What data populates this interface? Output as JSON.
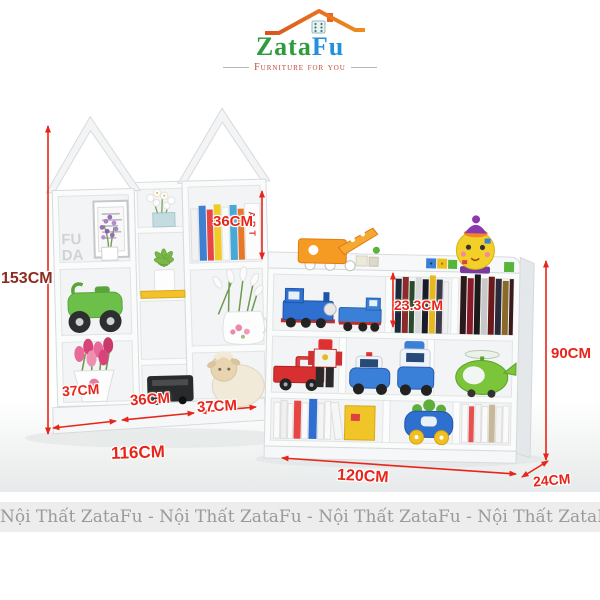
{
  "logo": {
    "brand_zata": "Zata",
    "brand_fu": "Fu",
    "tagline": "Furniture for you",
    "colors": {
      "zata": "#2f9b3f",
      "fu": "#2191d9",
      "roof": "#e8632b",
      "tagline": "#c04838"
    }
  },
  "dimensions": {
    "total_height_left": "153CM",
    "left_column_width": "37CM",
    "middle_column_width": "36CM",
    "right_column_width": "37CM",
    "left_unit_width": "116CM",
    "top_shelf_height": "36CM",
    "cubby_height": "23.3CM",
    "right_unit_height": "90CM",
    "right_unit_width": "120CM",
    "right_unit_depth": "24CM",
    "accent_color": "#e8251a",
    "height_label_color": "#8f2a21"
  },
  "decor": {
    "letters_top": "FU",
    "letters_bottom": "DA",
    "book_spine": "ART"
  },
  "footer": {
    "text": "Nội Thất ZataFu  -  Nội Thất ZataFu  -  Nội Thất ZataFu  -  Nội Thất ZataFu"
  }
}
